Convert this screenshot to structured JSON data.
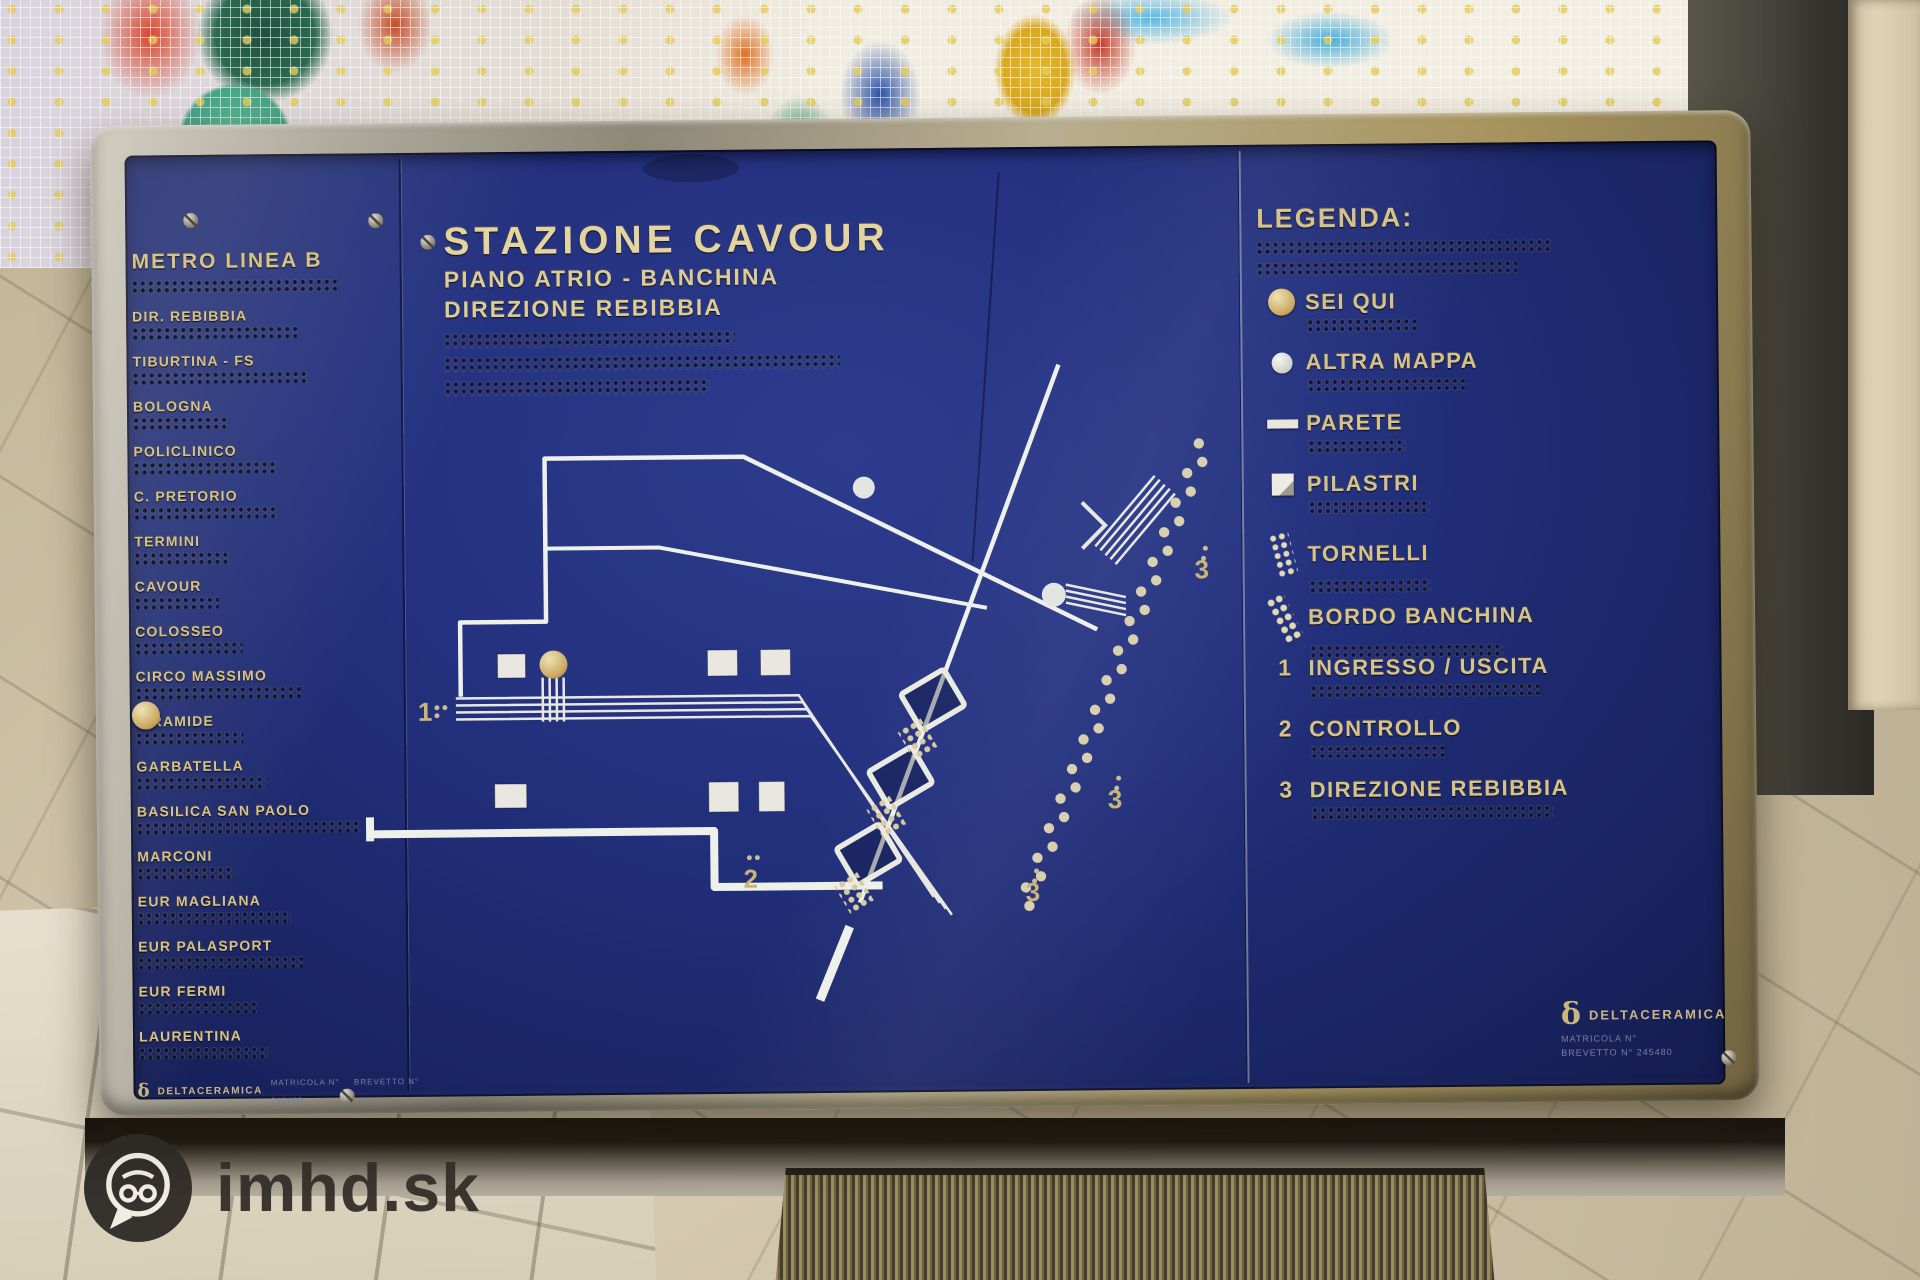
{
  "watermark": {
    "text": "imhd.sk"
  },
  "panel": {
    "line_header": "METRO LINEA B",
    "stations": [
      "DIR. REBIBBIA",
      "TIBURTINA - FS",
      "BOLOGNA",
      "POLICLINICO",
      "C. PRETORIO",
      "TERMINI",
      "CAVOUR",
      "COLOSSEO",
      "CIRCO MASSIMO",
      "PIRAMIDE",
      "GARBATELLA",
      "BASILICA SAN PAOLO",
      "MARCONI",
      "EUR MAGLIANA",
      "EUR PALASPORT",
      "EUR FERMI",
      "LAURENTINA"
    ],
    "you_are_here": "CAVOUR",
    "title_block": {
      "title": "STAZIONE CAVOUR",
      "line2": "PIANO ATRIO - BANCHINA",
      "line3": "DIREZIONE REBIBBIA"
    },
    "legend": {
      "header": "LEGENDA:",
      "items": [
        {
          "label": "SEI QUI",
          "icon": "gold-dot"
        },
        {
          "label": "ALTRA MAPPA",
          "icon": "white-dot"
        },
        {
          "label": "PARETE",
          "icon": "wall-bar"
        },
        {
          "label": "PILASTRI",
          "icon": "pillar-square"
        },
        {
          "label": "TORNELLI",
          "icon": "turnstile-dots"
        },
        {
          "label": "BORDO BANCHINA",
          "icon": "platform-edge-dots"
        },
        {
          "label": "INGRESSO / USCITA",
          "marker": "1"
        },
        {
          "label": "CONTROLLO",
          "marker": "2"
        },
        {
          "label": "DIREZIONE REBIBBIA",
          "marker": "3"
        }
      ]
    },
    "map": {
      "markers": {
        "entrance": "1",
        "control": "2",
        "direction": "3"
      }
    },
    "maker": {
      "symbol": "δ",
      "name": "DELTACERAMICA",
      "line1": "MATRICOLA N°",
      "line2": "BREVETTO N° 245480"
    }
  },
  "colors": {
    "panel_blue": "#202d78",
    "engraved_gold": "#d6c38a",
    "frame_metal": "#b0a890",
    "map_white": "#eef0ea",
    "mosaic_red": "#cc3a24",
    "mosaic_teal": "#4fae8d",
    "mosaic_yellow": "#e5bb2e",
    "mosaic_blue": "#3b6fc0"
  }
}
